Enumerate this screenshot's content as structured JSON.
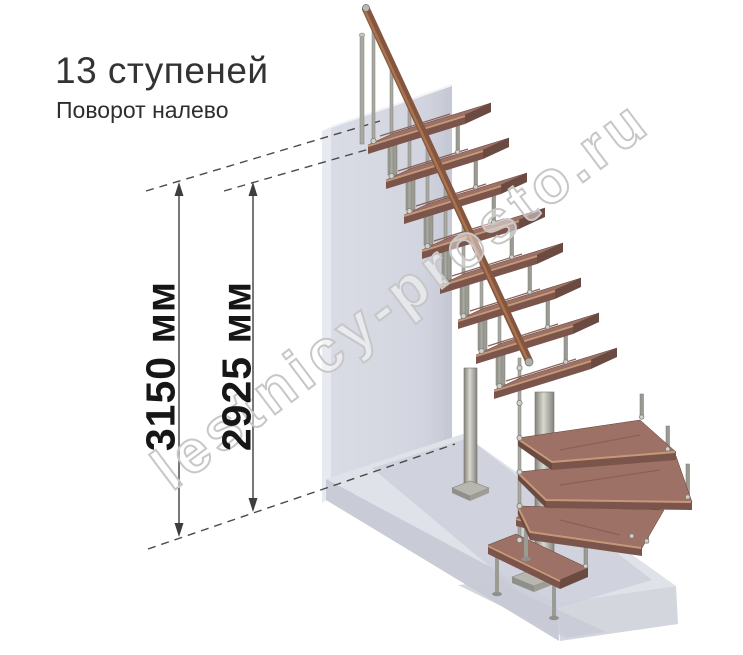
{
  "title": "13 ступеней",
  "subtitle": "Поворот налево",
  "dimensions": {
    "outer": "3150 мм",
    "inner": "2925 мм"
  },
  "watermark": "lestnicy-prosto.ru",
  "steps_count": "13",
  "turn_direction": "налево",
  "colors": {
    "tread_wood": "#9d7166",
    "tread_front": "#7b554c",
    "handrail_wood": "#85563f",
    "metal": "#a9a9a2",
    "wall": "#d5d7e1",
    "floor": "#e0e2e9",
    "dimension_lines": "#3e3e3e"
  }
}
